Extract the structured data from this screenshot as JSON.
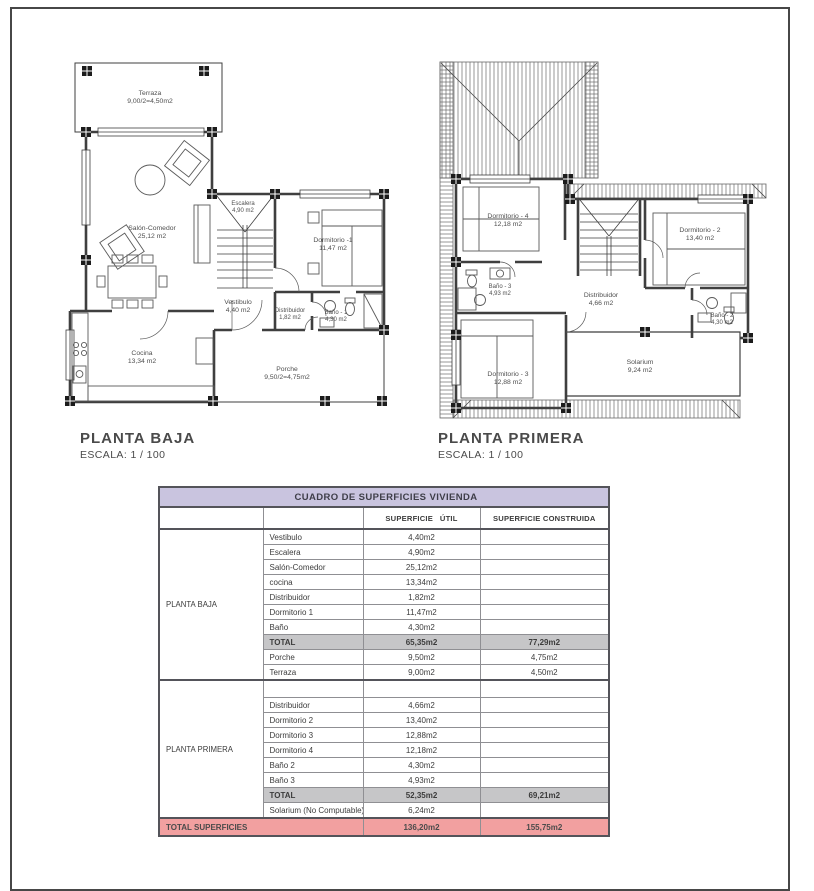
{
  "colors": {
    "title_bg": "#c9c4df",
    "total_bg": "#c6c6c8",
    "grand_total_bg": "#f2a0a0",
    "line": "#3f3f3f"
  },
  "plans": [
    {
      "title": "PLANTA BAJA",
      "scale": "ESCALA: 1 / 100",
      "rooms": [
        {
          "name": "Terraza",
          "area": "9,00/2=4,50m2"
        },
        {
          "name": "Salón-Comedor",
          "area": "25,12 m2"
        },
        {
          "name": "Escalera",
          "area": "4,90 m2"
        },
        {
          "name": "Dormitorio -1",
          "area": "11,47 m2"
        },
        {
          "name": "Vestibulo",
          "area": "4,40 m2"
        },
        {
          "name": "Distribuidor",
          "area": "1,82 m2"
        },
        {
          "name": "Baño - 1",
          "area": "4,30 m2"
        },
        {
          "name": "Cocina",
          "area": "13,34 m2"
        },
        {
          "name": "Porche",
          "area": "9,50/2=4,75m2"
        }
      ]
    },
    {
      "title": "PLANTA PRIMERA",
      "scale": "ESCALA: 1 / 100",
      "rooms": [
        {
          "name": "Dormitorio - 4",
          "area": "12,18 m2"
        },
        {
          "name": "Dormitorio - 2",
          "area": "13,40 m2"
        },
        {
          "name": "Baño - 3",
          "area": "4,93 m2"
        },
        {
          "name": "Distribuidor",
          "area": "4,66 m2"
        },
        {
          "name": "Baño - 2",
          "area": "4,30 m2"
        },
        {
          "name": "Dormitorio - 3",
          "area": "12,88 m2"
        },
        {
          "name": "Solarium",
          "area": "9,24 m2"
        }
      ]
    }
  ],
  "table": {
    "title": "CUADRO DE SUPERFICIES  VIVIENDA",
    "col_util": "SUPERFICIE   ÚTIL",
    "col_construida": "SUPERFICIE CONSTRUIDA",
    "sections": [
      {
        "label": "PLANTA BAJA",
        "rows": [
          {
            "name": "Vestibulo",
            "util": "4,40m2",
            "construida": ""
          },
          {
            "name": "Escalera",
            "util": "4,90m2",
            "construida": ""
          },
          {
            "name": "Salón-Comedor",
            "util": "25,12m2",
            "construida": ""
          },
          {
            "name": "cocina",
            "util": "13,34m2",
            "construida": ""
          },
          {
            "name": "Distribuidor",
            "util": "1,82m2",
            "construida": ""
          },
          {
            "name": "Dormitorio 1",
            "util": "11,47m2",
            "construida": ""
          },
          {
            "name": "Baño",
            "util": "4,30m2",
            "construida": ""
          },
          {
            "name": "TOTAL",
            "util": "65,35m2",
            "construida": "77,29m2",
            "type": "total"
          },
          {
            "name": "Porche",
            "util": "9,50m2",
            "construida": "4,75m2"
          },
          {
            "name": "Terraza",
            "util": "9,00m2",
            "construida": "4,50m2"
          }
        ]
      },
      {
        "label": "PLANTA PRIMERA",
        "rows": [
          {
            "name": "",
            "util": "",
            "construida": "",
            "type": "spacer"
          },
          {
            "name": "Distribuidor",
            "util": "4,66m2",
            "construida": ""
          },
          {
            "name": "Dormitorio 2",
            "util": "13,40m2",
            "construida": ""
          },
          {
            "name": "Dormitorio 3",
            "util": "12,88m2",
            "construida": ""
          },
          {
            "name": "Dormitorio 4",
            "util": "12,18m2",
            "construida": ""
          },
          {
            "name": "Baño 2",
            "util": "4,30m2",
            "construida": ""
          },
          {
            "name": "Baño 3",
            "util": "4,93m2",
            "construida": ""
          },
          {
            "name": "TOTAL",
            "util": "52,35m2",
            "construida": "69,21m2",
            "type": "total"
          },
          {
            "name": "Solarium (No Computable)",
            "util": "6,24m2",
            "construida": ""
          }
        ]
      }
    ],
    "footer": {
      "label": "TOTAL SUPERFICIES",
      "util": "136,20m2",
      "construida": "155,75m2"
    }
  }
}
